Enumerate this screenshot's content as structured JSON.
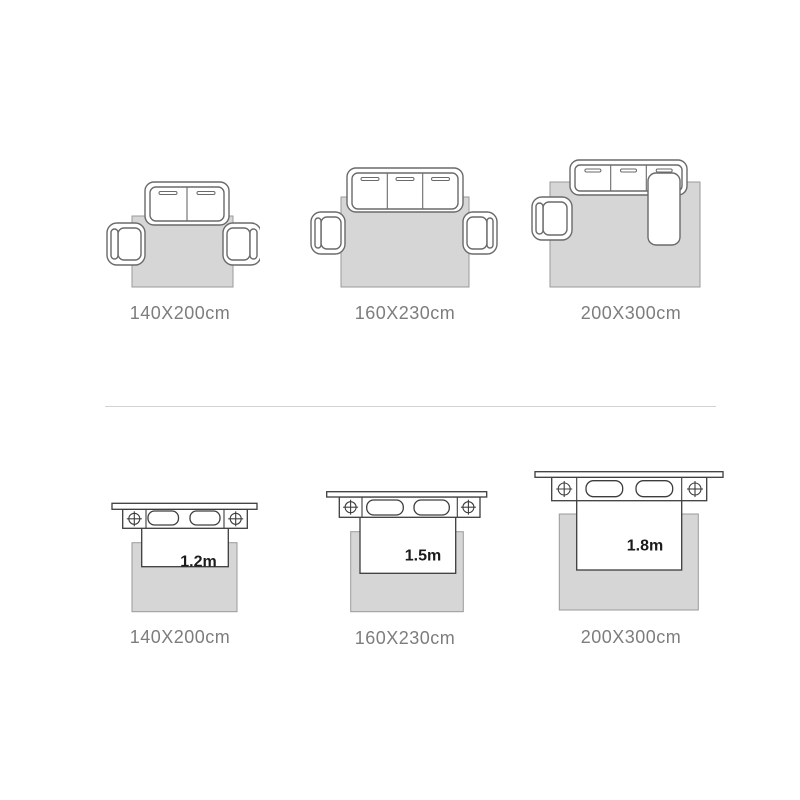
{
  "page": {
    "background": "#ffffff",
    "description": "Rug size guide with sofa and bed layout diagrams"
  },
  "colors": {
    "rug_fill": "#d6d6d6",
    "rug_stroke": "#9a9a9a",
    "sofa_stroke": "#6a6a6a",
    "bed_stroke": "#3d3d3d",
    "label_color": "#7d7d7d",
    "bed_size_text_color": "#1b1b1b",
    "divider_color": "#d2d2d2"
  },
  "sofa_row": {
    "items": [
      {
        "label": "140X200cm",
        "type": "two-seat-sofa-with-two-armchairs"
      },
      {
        "label": "160X230cm",
        "type": "three-seat-sofa-with-two-armchairs"
      },
      {
        "label": "200X300cm",
        "type": "sectional-sofa-with-armchair"
      }
    ]
  },
  "bed_row": {
    "items": [
      {
        "label": "140X200cm",
        "bed_width": "1.2m"
      },
      {
        "label": "160X230cm",
        "bed_width": "1.5m"
      },
      {
        "label": "200X300cm",
        "bed_width": "1.8m"
      }
    ]
  }
}
